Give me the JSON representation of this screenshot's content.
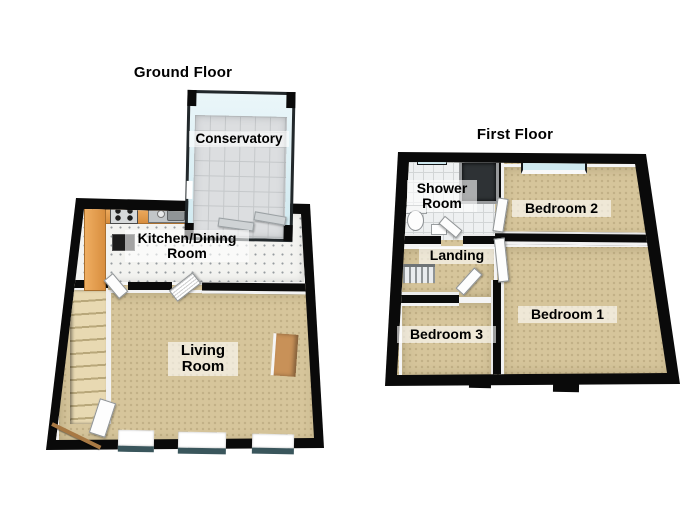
{
  "ground_floor": {
    "title": "Ground Floor",
    "rooms": {
      "conservatory": "Conservatory",
      "kitchen_dining": "Kitchen/Dining Room",
      "living": "Living Room"
    }
  },
  "first_floor": {
    "title": "First Floor",
    "rooms": {
      "shower": "Shower Room",
      "bedroom2": "Bedroom 2",
      "landing": "Landing",
      "bedroom3": "Bedroom 3",
      "bedroom1": "Bedroom 1"
    }
  },
  "colors": {
    "wall": "#0a0a0a",
    "carpet": "#d6c59b",
    "kitchen-floor": "#f3f3f0",
    "tile": "#dcdee0",
    "tile-line": "#c5c8ca",
    "shower-tile": "#eef0f1",
    "glass-light": "#cfe9f0",
    "glass-dark": "#3a565c",
    "counter": "#e09a4f",
    "wood-door": "#a87944",
    "white-wall": "#f2f2f2",
    "label-bg": "#ffffff99"
  }
}
